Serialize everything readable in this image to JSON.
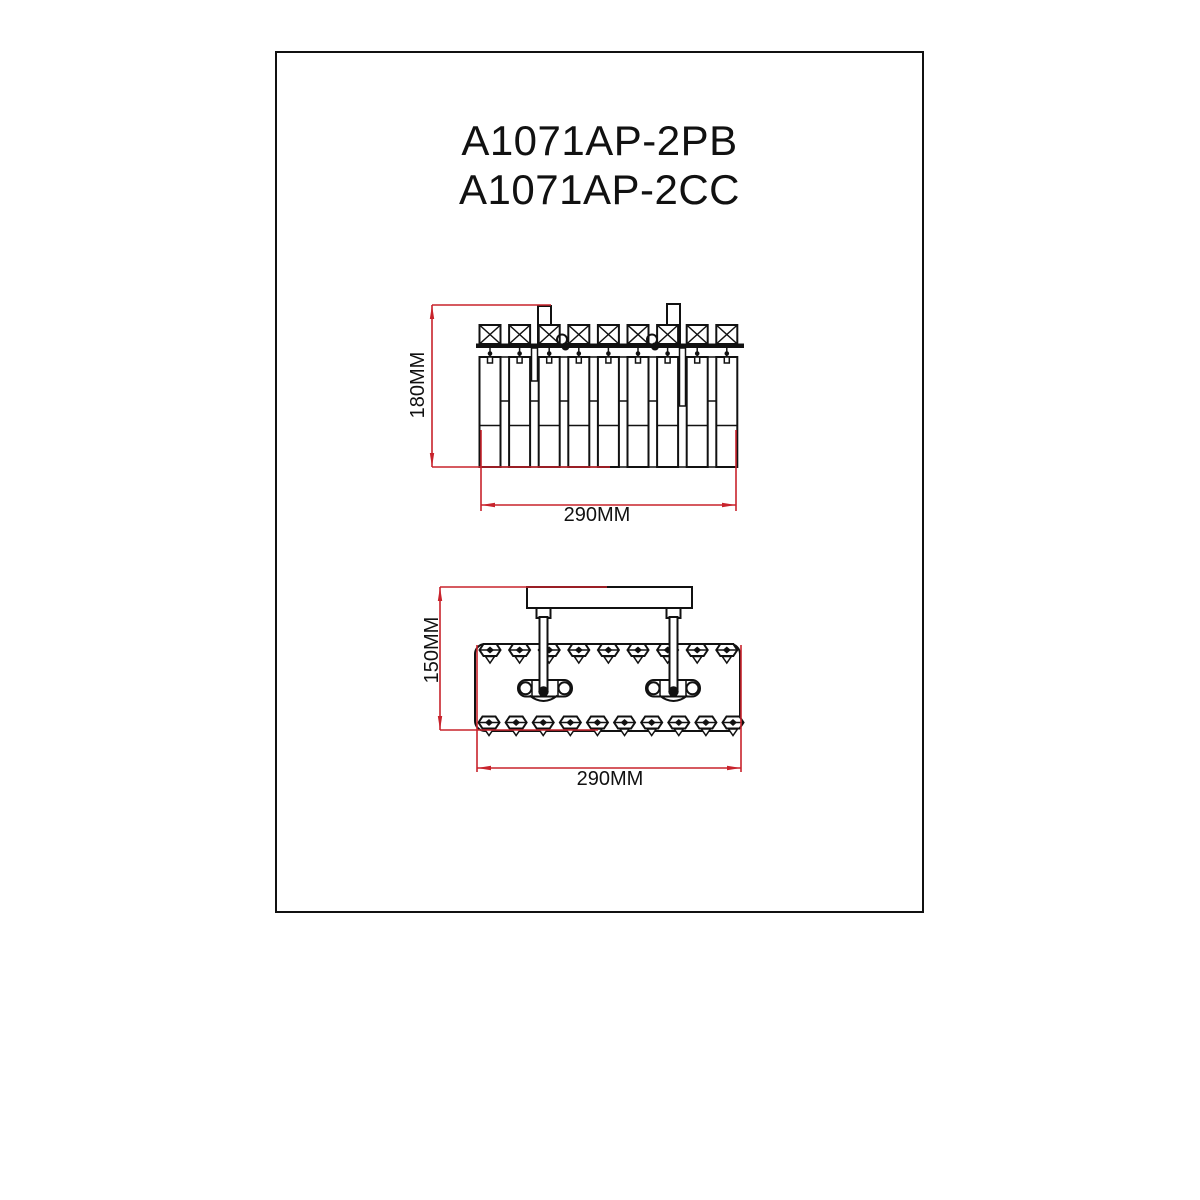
{
  "colors": {
    "ink": "#111111",
    "dimension": "#c8232c",
    "background": "#ffffff"
  },
  "title": {
    "line1": "A1071AP-2PB",
    "line2": "A1071AP-2CC"
  },
  "front_view": {
    "height_label": "180MM",
    "width_label": "290MM",
    "crystal_columns": 9,
    "hanging_loops": 2
  },
  "top_view": {
    "height_label": "150MM",
    "width_label": "290MM",
    "top_prisms": 9,
    "bottom_prisms": 10,
    "sockets": 2
  }
}
